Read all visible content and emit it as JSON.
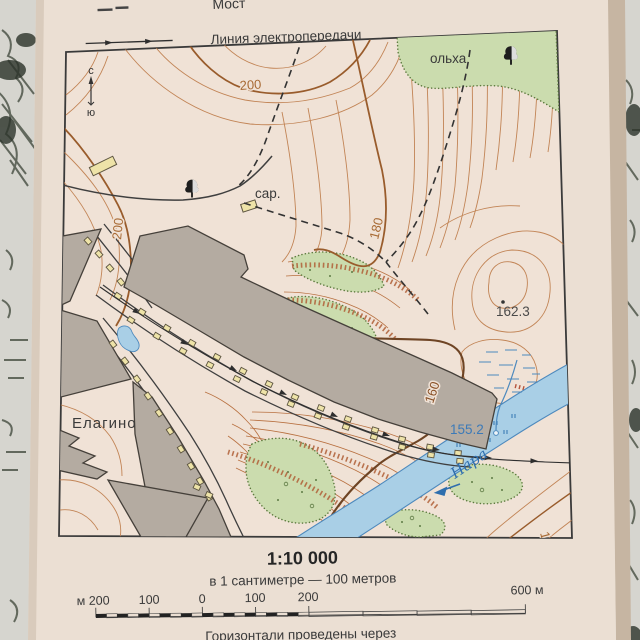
{
  "legend": {
    "partial_item": {
      "label": "Мост"
    },
    "power_line_item": {
      "label": "Линия электропередачи"
    }
  },
  "compass": {
    "north_label": "с",
    "south_label": "ю"
  },
  "map_labels": {
    "settlement": "Елагино",
    "river_name": "Нара",
    "river_flow": "flow-arrow-southwest",
    "forest": "ольха",
    "barn": "сар.",
    "contour_200_top": "200",
    "contour_200_left": "200",
    "contour_180": "180",
    "contour_160_mid": "160",
    "contour_160_se": "160",
    "spot_height": "162.3",
    "water_edge_mark": "155.2"
  },
  "scale_block": {
    "ratio": "1:10 000",
    "verbal": "в 1 сантиметре — 100 метров",
    "bar_left_label": "м 200",
    "bar_labels": [
      "100",
      "0",
      "100",
      "200"
    ],
    "bar_right_label": "600 м",
    "footer_partial": "Горизонтали проведены через"
  },
  "colors": {
    "contour": "#bf7f4f",
    "index_contour": "#995c2c",
    "water_fill": "#a9cfe6",
    "water_line": "#4d89bd",
    "vegetation": "#cbdcae",
    "block_fill": "#b4aba1",
    "building_fill": "#eee3a8",
    "paper": "#f0e2d6"
  }
}
